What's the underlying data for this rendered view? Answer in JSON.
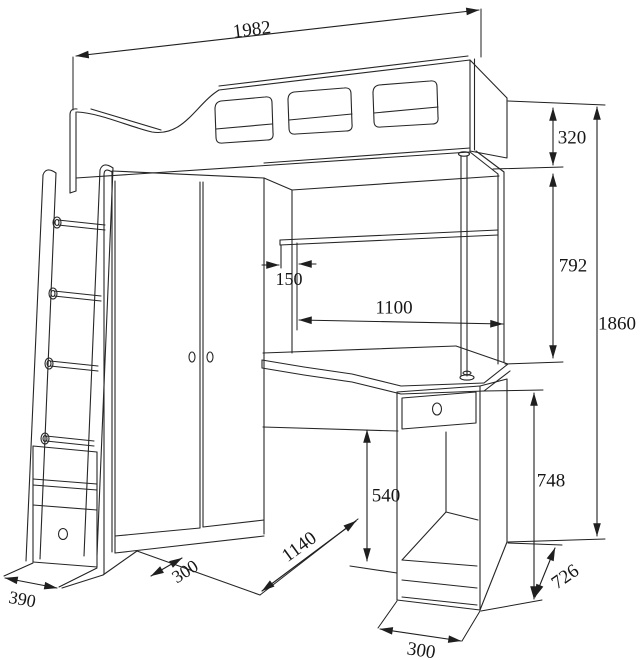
{
  "diagram": {
    "subject": "loft bed with wardrobe, corner desk, pedestal and ladder",
    "line_color": "#262626",
    "background": "#ffffff",
    "dimensions": {
      "overall_length": "1982",
      "bed_box_height": "320",
      "bed_underside_clearance": "792",
      "overall_height": "1860",
      "shelf_inset": "150",
      "desk_shelf_width": "1100",
      "under_desk_height": "540",
      "desk_height": "748",
      "desk_depth": "726",
      "pedestal_width": "300",
      "floor_front_span": "1140",
      "wardrobe_front_depth": "300",
      "ladder_base_depth": "390"
    }
  }
}
